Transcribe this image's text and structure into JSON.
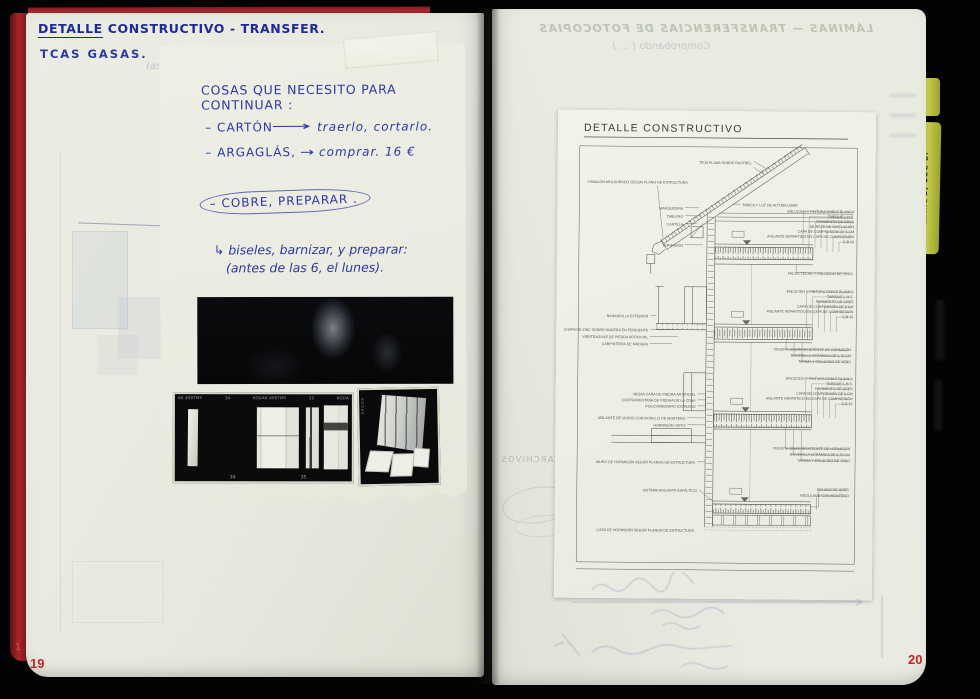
{
  "colors": {
    "cover_red": "#a9242a",
    "ink_blue": "#2c38a4",
    "page_number_red": "#c0252c",
    "tab_yellow": "#b9bd3e",
    "page_cream": "#e8e9df",
    "sheet_white": "#f1f1e9"
  },
  "notebook": {
    "left_page": {
      "heading_word_underlined": "DETALLE",
      "heading_rest": " CONSTRUCTIVO - TRANSFER.",
      "heading_line2": "TCAS GASAS.",
      "ghost_note": "(aso",
      "page_number_partial": "1",
      "page_number": "19",
      "note": {
        "title": "COSAS QUE NECESITO PARA CONTINUAR :",
        "item1_label": "– CARTÓN",
        "item1_arrow": "⟶",
        "item1_action": "traerlo, cortarlo.",
        "item2_label": "– ARGAGLÁS,",
        "item2_arrow": "→",
        "item2_action": "comprar. 16 €",
        "item3_circled": "– COBRE, PREPARAR .",
        "followup_line1": "↳ biseles, barnizar, y preparar:",
        "followup_line2": "(antes de las 6, el lunes)."
      },
      "film_strip": {
        "edge_top": [
          "AK 400TMY",
          "3A",
          "KODAK 400TMY",
          "35",
          "KODA"
        ],
        "edge_bottom": [
          "34",
          "35"
        ],
        "single_frame_edge": "KODAK"
      }
    },
    "right_page": {
      "page_number": "20",
      "ghost_showthrough_line1": "LÁMINAS — TRANSFERENCIAS DE FOTOCOPIAS",
      "ghost_showthrough_line2": "Comprobando ( … )",
      "ghost_showthrough_archivos": "ARCHIVOS",
      "tab_label": "…ANDO, LOC 8.",
      "sheet": {
        "title": "DETALLE CONSTRUCTIVO",
        "labels": [
          "TEJA PLANA SOBRE RASTREL",
          "CANALÓN MOLDURADO SEGÚN PLANO DE ESTRUCTURA",
          "TABICA Y LUZ DE ALTURA LIBRE",
          "ENLUCIDO Y PINTURA DOBLE BLANCA",
          "TABIQUE L.H.S.",
          "PAVIMENTO DE GRES",
          "MURETE DE NIVELACIÓN",
          "CAPA DE COMPRESIÓN DE 5 CM",
          "AISLANTE REPARTIDO EN CAPA DE COMPRESIÓN",
          "C.B 16",
          "MARQUESINA",
          "TABLERO",
          "CARTELA",
          "HORMIGÓN",
          "FALSO TECHO Y ENLUCIDO DE YESO",
          "BARANDILLA EXTERIOR",
          "CHAPA DE ZINC SOBRE MADERA EN PENDIENTE",
          "VIERTEAGUAS DE PIEDRA ARTIFICIAL",
          "CARPINTERÍA DE MADERA",
          "VIGUETA SEMIRRESISTENTE DE HORMIGÓN",
          "BOVEDILLA CERÁMICA DE 0,70 CM",
          "TARIMA Y ENLUCIDO DE YESO",
          "MEDIA CAÑA DE PIEDRA ARTIFICIAL",
          "CONTRAVENTANA DE PIEDRA DE LA ZONA",
          "POLICARBONATO EXTRUIDO",
          "AISLANTE DE VIDRIO CON RODILLO DE MORTERO",
          "HORMIGÓN VISTO",
          "MURO DE HORMIGÓN SEGÚN PLANOS DE ESTRUCTURA",
          "SISTEMA AISLANTE ASFÁLTICO",
          "SOLADO DE GRES",
          "REGULADO CON MORTERO",
          "LOSA DE HORMIGÓN SEGÚN PLANOS DE ESTRUCTURA"
        ]
      }
    }
  }
}
